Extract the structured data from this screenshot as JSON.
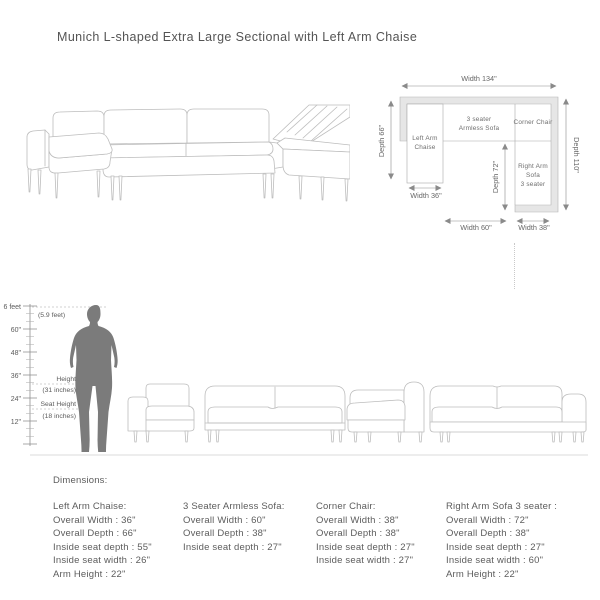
{
  "title": "Munich L-shaped Extra Large Sectional with Left Arm Chaise",
  "colors": {
    "line": "#bdbdbd",
    "band_fill": "#e6e6e6",
    "text": "#5c5c5c",
    "silhouette": "#7b7b7b"
  },
  "floor_plan": {
    "width_total": "Width 134\"",
    "depth_total": "Depth 110\"",
    "chaise_depth": "Depth 66\"",
    "chaise_width": "Width 36\"",
    "inner_depth": "Depth 72\"",
    "armless_width": "Width 60\"",
    "right_width": "Width 38\"",
    "chaise_label_1": "Left Arm",
    "chaise_label_2": "Chaise",
    "armless_label_1": "3 seater",
    "armless_label_2": "Armless Sofa",
    "corner_label": "Corner Chair",
    "right_label_1": "Right Arm",
    "right_label_2": "Sofa",
    "right_label_3": "3 seater"
  },
  "scale": {
    "top_label": "6 feet",
    "person_height": "(5.9 feet)",
    "ticks": [
      "60\"",
      "48\"",
      "36\"",
      "24\"",
      "12\""
    ],
    "height_label": "Height",
    "height_value": "(31 inches)",
    "seat_height_label": "Seat Height",
    "seat_height_value": "(18 inches)"
  },
  "dimensions": {
    "heading": "Dimensions:",
    "columns": [
      {
        "title": "Left Arm Chaise:",
        "lines": [
          "Overall Width : 36\"",
          "Overall Depth : 66\"",
          "Inside seat depth : 55\"",
          "Inside seat width : 26\"",
          "Arm Height : 22\""
        ]
      },
      {
        "title": "3 Seater Armless Sofa:",
        "lines": [
          "Overall Width : 60\"",
          "Overall Depth : 38\"",
          "Inside seat depth : 27\""
        ]
      },
      {
        "title": "Corner Chair:",
        "lines": [
          "Overall Width : 38\"",
          "Overall Depth : 38\"",
          "Inside seat depth : 27\"",
          "Inside seat width : 27\""
        ]
      },
      {
        "title": "Right Arm Sofa 3 seater :",
        "lines": [
          "Overall Width : 72\"",
          "Overall Depth : 38\"",
          "Inside seat depth : 27\"",
          "Inside seat width : 60\"",
          "Arm Height : 22\""
        ]
      }
    ]
  }
}
